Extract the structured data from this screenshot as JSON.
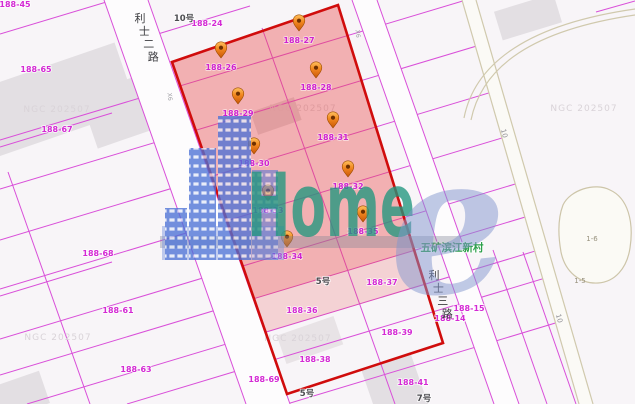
{
  "colors": {
    "selection_border": "#d00c0c",
    "selection_fill": "#e84848",
    "parcel_line": "#d94fd9",
    "parcel_label": "#d42ad4",
    "poi_green": "#2da04b",
    "logo_teal": "#20967e",
    "logo_blue": "#4d72d6",
    "pin_orange": "#f1861f",
    "watermark_gray": "#d9d3d8"
  },
  "map": {
    "watermark_text": "NGC 202507",
    "watermark_positions": [
      [
        57,
        112
      ],
      [
        303,
        111
      ],
      [
        584,
        111
      ],
      [
        58,
        340
      ],
      [
        298,
        341
      ]
    ],
    "roads": [
      {
        "name": "利士二路",
        "start": [
          140,
          22
        ],
        "step": [
          4.4,
          12.8
        ]
      },
      {
        "name": "利士三路",
        "start": [
          434,
          279
        ],
        "step": [
          4.4,
          12.8
        ]
      }
    ],
    "road_markers": [
      {
        "text": "10",
        "x": 502,
        "y": 134,
        "rotate": 75,
        "small": false
      },
      {
        "text": "10",
        "x": 557,
        "y": 319,
        "rotate": 75,
        "small": false
      },
      {
        "text": "X6",
        "x": 168,
        "y": 97,
        "rotate": 83,
        "small": true
      },
      {
        "text": "X6",
        "x": 356,
        "y": 34,
        "rotate": 83,
        "small": true
      }
    ],
    "building_numbers": [
      {
        "text": "10号",
        "x": 184,
        "y": 21
      },
      {
        "text": "5号",
        "x": 323,
        "y": 284
      },
      {
        "text": "5号",
        "x": 307,
        "y": 396
      },
      {
        "text": "7号",
        "x": 424,
        "y": 401
      }
    ],
    "parcel_labels": [
      {
        "text": "188-45",
        "x": 15,
        "y": 7
      },
      {
        "text": "188-24",
        "x": 207,
        "y": 26
      },
      {
        "text": "188-65",
        "x": 36,
        "y": 72
      },
      {
        "text": "188-67",
        "x": 57,
        "y": 132
      },
      {
        "text": "188-68",
        "x": 98,
        "y": 256
      },
      {
        "text": "188-61",
        "x": 118,
        "y": 313
      },
      {
        "text": "188-63",
        "x": 136,
        "y": 372
      },
      {
        "text": "188-69",
        "x": 264,
        "y": 382
      },
      {
        "text": "188-37",
        "x": 382,
        "y": 285
      },
      {
        "text": "188-36",
        "x": 302,
        "y": 313
      },
      {
        "text": "188-39",
        "x": 397,
        "y": 335
      },
      {
        "text": "188-38",
        "x": 315,
        "y": 362
      },
      {
        "text": "188-41",
        "x": 413,
        "y": 385
      },
      {
        "text": "188-15",
        "x": 469,
        "y": 311
      },
      {
        "text": "188-14",
        "x": 450,
        "y": 321
      }
    ],
    "terrain_labels": [
      {
        "text": "1-6",
        "x": 592,
        "y": 241
      },
      {
        "text": "1-5",
        "x": 580,
        "y": 283
      }
    ],
    "poi": {
      "text": "五矿滨江新村"
    },
    "pins": [
      {
        "label": "188-26",
        "x": 221,
        "y": 58
      },
      {
        "label": "188-27",
        "x": 299,
        "y": 31
      },
      {
        "label": "188-28",
        "x": 316,
        "y": 78
      },
      {
        "label": "188-29",
        "x": 238,
        "y": 104
      },
      {
        "label": "188-31",
        "x": 333,
        "y": 128
      },
      {
        "label": "188-30",
        "x": 254,
        "y": 154
      },
      {
        "label": "188-32",
        "x": 348,
        "y": 177
      },
      {
        "label": "188-33",
        "x": 268,
        "y": 201
      },
      {
        "label": "188-35",
        "x": 363,
        "y": 222
      },
      {
        "label": "188-34",
        "x": 287,
        "y": 247
      }
    ],
    "logo": {
      "main": "Home",
      "e": "e"
    }
  }
}
